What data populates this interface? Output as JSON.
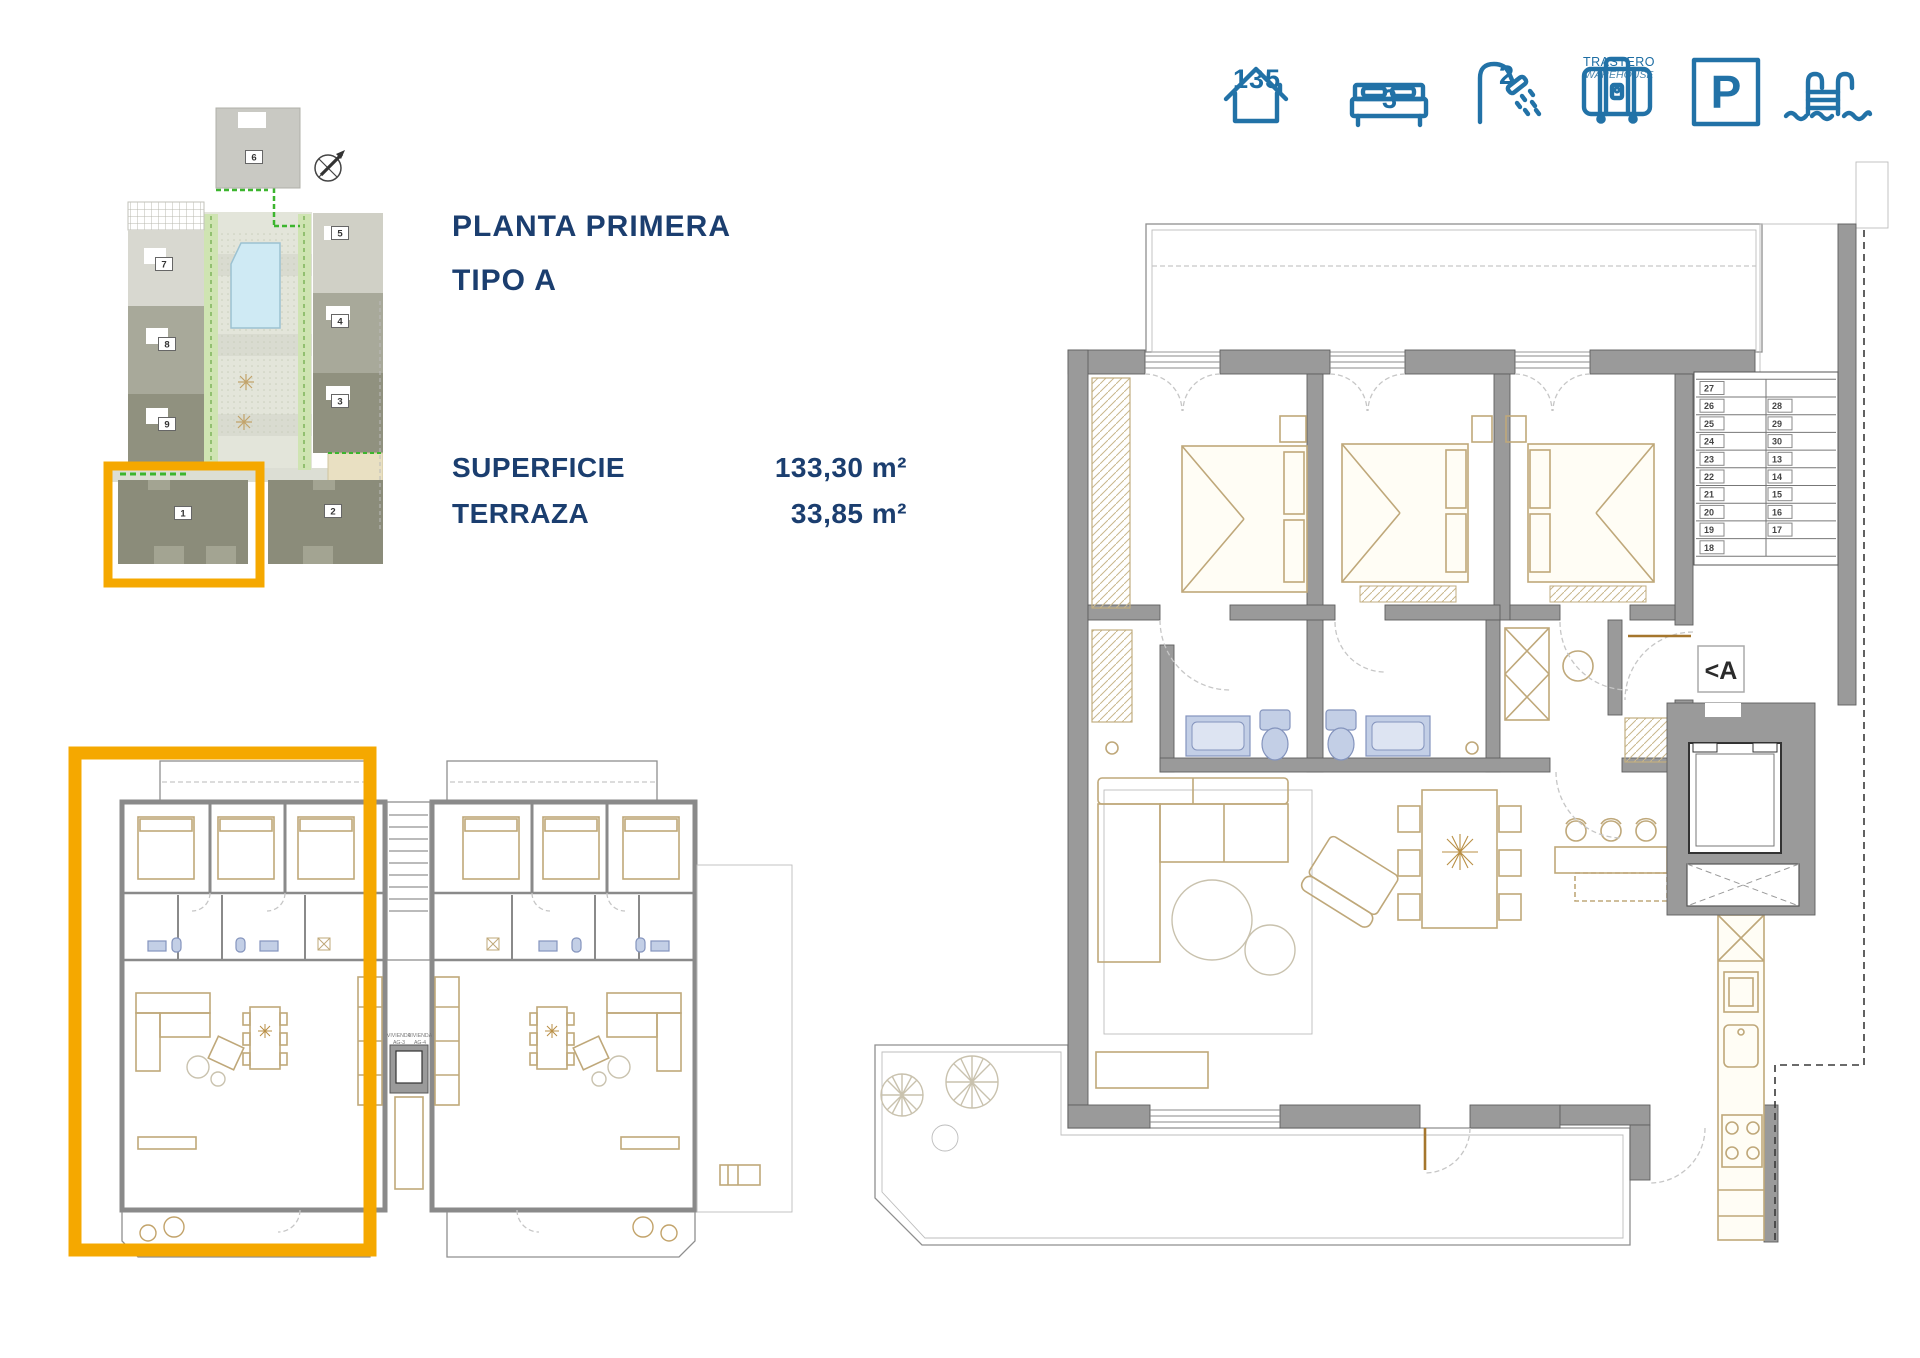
{
  "page": {
    "background": "#ffffff"
  },
  "header_icons": {
    "area": {
      "icon": "house-icon",
      "value": "135"
    },
    "bedrooms": {
      "icon": "bed-icon",
      "value": "3"
    },
    "bathrooms": {
      "icon": "shower-icon",
      "value": "2"
    },
    "storage": {
      "icon": "suitcase-icon",
      "line1": "TRASTERO",
      "line2": "WAREHOUSE"
    },
    "parking": {
      "icon": "parking-icon",
      "letter": "P"
    },
    "pool": {
      "icon": "pool-ladder-icon"
    },
    "accent_color": "#2272a7"
  },
  "info_panel": {
    "title_line1": "PLANTA PRIMERA",
    "title_line2": "TIPO A",
    "rows": [
      {
        "label": "SUPERFICIE",
        "value": "133,30 m²"
      },
      {
        "label": "TERRAZA",
        "value": "33,85 m²"
      }
    ],
    "text_color": "#1b3e6f"
  },
  "site_plan": {
    "unit_numbers": [
      "6",
      "7",
      "5",
      "8",
      "4",
      "9",
      "3",
      "1",
      "2"
    ],
    "highlight_color": "#F5A800",
    "pool_color": "#cfeaf4"
  },
  "overview_plan": {
    "unit_labels": [
      {
        "line1": "VIVIENDA",
        "line2": "AG-3"
      },
      {
        "line1": "VIVIENDA",
        "line2": "AG-4"
      }
    ],
    "highlight_color": "#F5A800"
  },
  "main_plan": {
    "entrance_label": "<A",
    "stairs": {
      "left_column": [
        "27",
        "26",
        "25",
        "24",
        "23",
        "22",
        "21",
        "20",
        "19",
        "18"
      ],
      "right_column": [
        "28",
        "29",
        "30",
        "13",
        "14",
        "15",
        "16",
        "17"
      ]
    }
  }
}
